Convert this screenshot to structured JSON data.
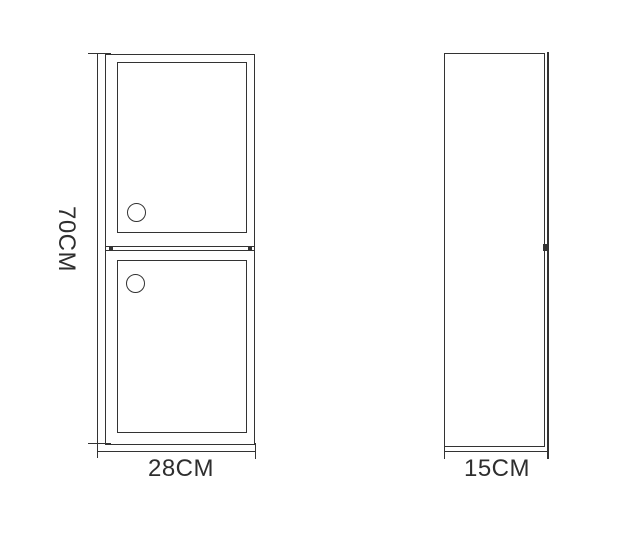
{
  "drawing": {
    "kind": "furniture-dimension-diagram",
    "front_view": {
      "height_label": "70CM",
      "width_label": "28CM"
    },
    "side_view": {
      "depth_label": "15CM"
    },
    "colors": {
      "line": "#333333",
      "text": "#2e2e2e",
      "background": "#ffffff"
    }
  }
}
